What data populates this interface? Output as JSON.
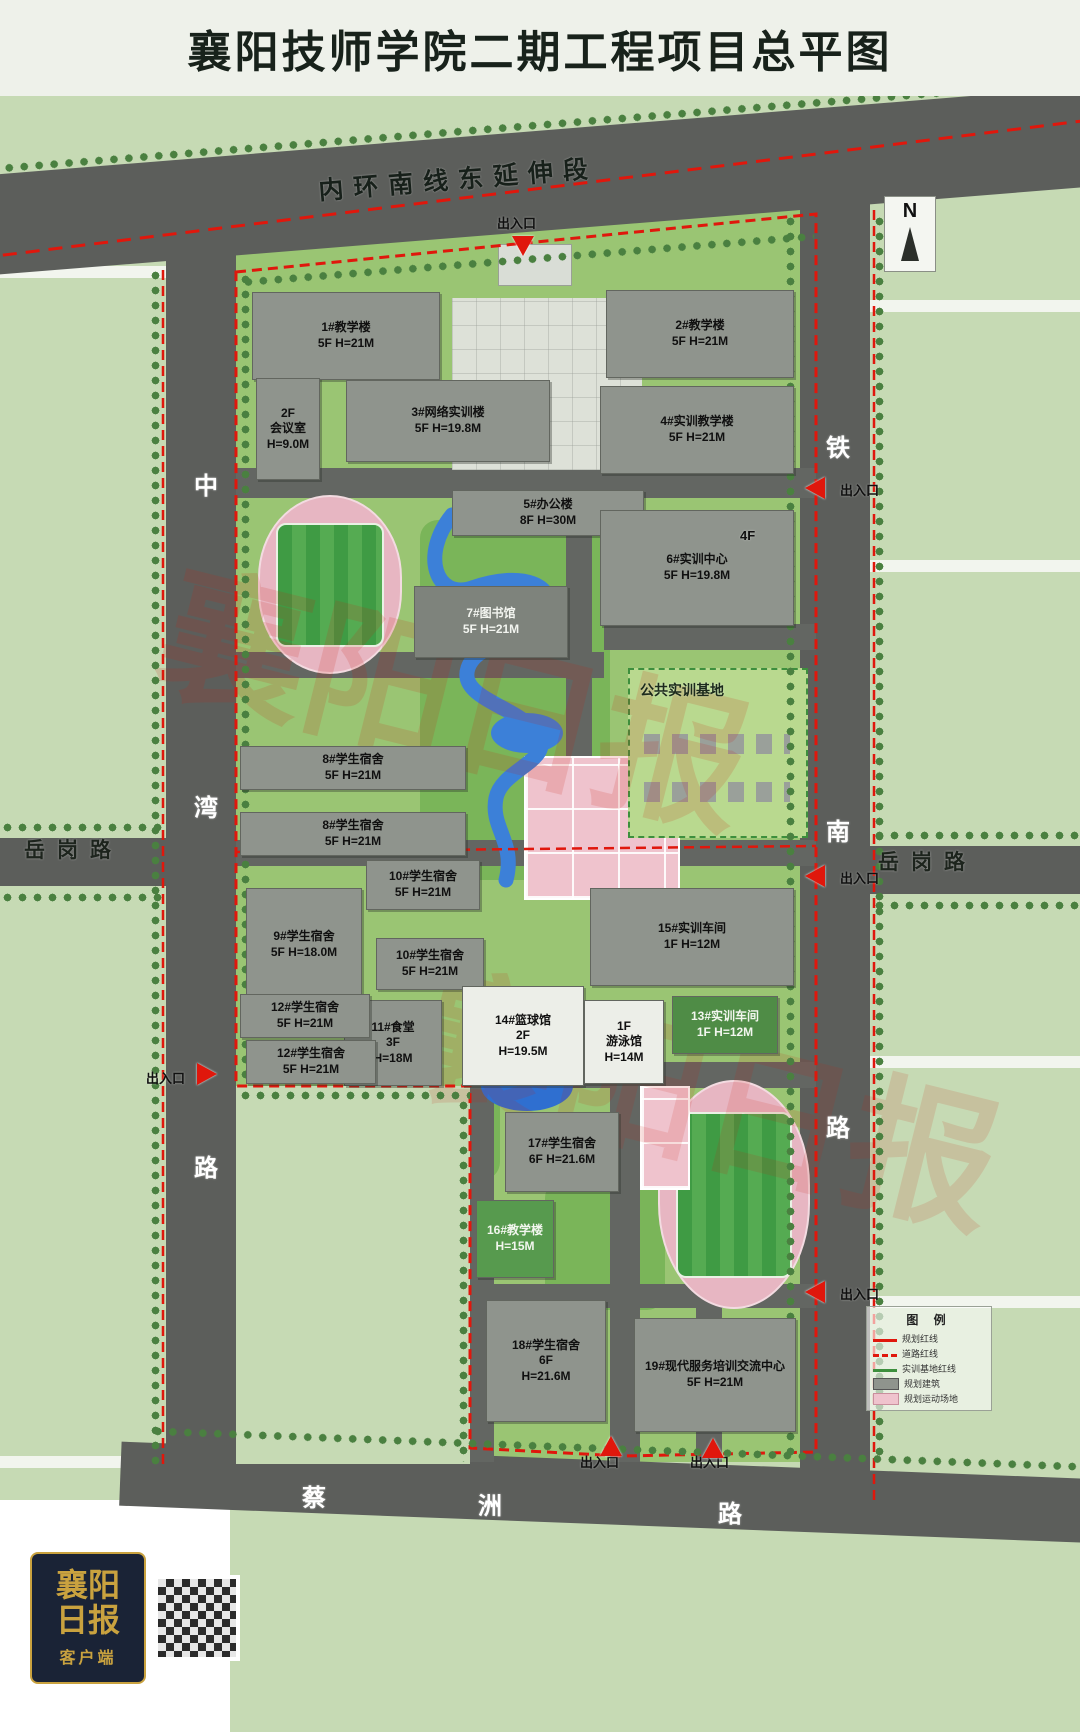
{
  "title": "襄阳技师学院二期工程项目总平图",
  "compass": {
    "label": "N"
  },
  "footer": {
    "logo_title": "襄阳日报",
    "logo_sub": "客户端"
  },
  "watermark": {
    "text": "襄阳日报",
    "color": "#cc2211"
  },
  "colors": {
    "road": "#5c5e5b",
    "campus_green": "#9ac573",
    "outer_green": "#c6dab4",
    "building_gray": "#8f948d",
    "red_line": "#e0170c",
    "track_pink": "#e7b6c2",
    "field_green": "#3f9b44",
    "water_blue": "#3c80d8",
    "header_bg": "#eef1ea"
  },
  "legend": {
    "title": "图 例",
    "items": [
      {
        "swatch": "red-line",
        "label": "规划红线"
      },
      {
        "swatch": "red-dash",
        "label": "道路红线"
      },
      {
        "swatch": "green-line",
        "label": "实训基地红线"
      },
      {
        "swatch": "gray-box",
        "label": "规划建筑"
      },
      {
        "swatch": "pink-box",
        "label": "规划运动场地"
      }
    ]
  },
  "roads": {
    "north": "内环南线东延伸段",
    "west_vertical": "中湾路",
    "east_vertical": "铁南路",
    "west_horizontal": "岳岗路",
    "east_horizontal": "岳岗路",
    "south": "蔡洲路",
    "entrance_label": "出入口"
  },
  "map": {
    "buildings": [
      {
        "id": "1",
        "lines": [
          "1#教学楼",
          "5F H=21M"
        ],
        "x": 252,
        "y": 292,
        "w": 186,
        "h": 86
      },
      {
        "id": "2",
        "lines": [
          "2#教学楼",
          "5F H=21M"
        ],
        "x": 606,
        "y": 290,
        "w": 186,
        "h": 86
      },
      {
        "id": "conf",
        "lines": [
          "2F",
          "会议室",
          "H=9.0M"
        ],
        "x": 256,
        "y": 378,
        "w": 62,
        "h": 100
      },
      {
        "id": "3",
        "lines": [
          "3#网络实训楼",
          "5F H=19.8M"
        ],
        "x": 346,
        "y": 380,
        "w": 202,
        "h": 80
      },
      {
        "id": "4",
        "lines": [
          "4#实训教学楼",
          "5F H=21M"
        ],
        "x": 600,
        "y": 386,
        "w": 192,
        "h": 86
      },
      {
        "id": "5",
        "lines": [
          "5#办公楼",
          "8F H=30M"
        ],
        "x": 452,
        "y": 490,
        "w": 190,
        "h": 44
      },
      {
        "id": "6",
        "lines": [
          "6#实训中心",
          "5F H=19.8M"
        ],
        "x": 600,
        "y": 510,
        "w": 192,
        "h": 114
      },
      {
        "id": "7",
        "lines": [
          "7#图书馆",
          "5F H=21M"
        ],
        "x": 414,
        "y": 586,
        "w": 152,
        "h": 70,
        "fill": "#7e837c",
        "text": "#f2f4ef"
      },
      {
        "id": "8a",
        "lines": [
          "8#学生宿舍",
          "5F H=21M"
        ],
        "x": 240,
        "y": 746,
        "w": 224,
        "h": 42
      },
      {
        "id": "8b",
        "lines": [
          "8#学生宿舍",
          "5F H=21M"
        ],
        "x": 240,
        "y": 812,
        "w": 224,
        "h": 42
      },
      {
        "id": "10a",
        "lines": [
          "10#学生宿舍",
          "5F H=21M"
        ],
        "x": 366,
        "y": 860,
        "w": 112,
        "h": 48
      },
      {
        "id": "9",
        "lines": [
          "9#学生宿舍",
          "5F H=18.0M"
        ],
        "x": 246,
        "y": 888,
        "w": 114,
        "h": 112
      },
      {
        "id": "10b",
        "lines": [
          "10#学生宿舍",
          "5F H=21M"
        ],
        "x": 376,
        "y": 938,
        "w": 106,
        "h": 50
      },
      {
        "id": "11",
        "lines": [
          "11#食堂",
          "3F",
          "H=18M"
        ],
        "x": 344,
        "y": 1000,
        "w": 96,
        "h": 84
      },
      {
        "id": "15",
        "lines": [
          "15#实训车间",
          "1F H=12M"
        ],
        "x": 590,
        "y": 888,
        "w": 202,
        "h": 96
      },
      {
        "id": "14",
        "lines": [
          "14#篮球馆",
          "2F",
          "H=19.5M"
        ],
        "x": 462,
        "y": 986,
        "w": 120,
        "h": 98,
        "fill": "#eceee8"
      },
      {
        "id": "swim",
        "lines": [
          "1F",
          "游泳馆",
          "H=14M"
        ],
        "x": 584,
        "y": 1000,
        "w": 78,
        "h": 82,
        "fill": "#eceee8"
      },
      {
        "id": "13",
        "lines": [
          "13#实训车间",
          "1F H=12M"
        ],
        "x": 672,
        "y": 996,
        "w": 104,
        "h": 56,
        "fill": "#4f8c46",
        "text": "#f2f6ee"
      },
      {
        "id": "12a",
        "lines": [
          "12#学生宿舍",
          "5F H=21M"
        ],
        "x": 240,
        "y": 994,
        "w": 128,
        "h": 42
      },
      {
        "id": "12b",
        "lines": [
          "12#学生宿舍",
          "5F H=21M"
        ],
        "x": 246,
        "y": 1040,
        "w": 128,
        "h": 42
      },
      {
        "id": "17",
        "lines": [
          "17#学生宿舍",
          "6F H=21.6M"
        ],
        "x": 505,
        "y": 1112,
        "w": 112,
        "h": 78
      },
      {
        "id": "16",
        "lines": [
          "16#教学楼",
          "H=15M"
        ],
        "x": 476,
        "y": 1200,
        "w": 76,
        "h": 76,
        "fill": "#579a4e",
        "text": "#f2f6ee"
      },
      {
        "id": "18",
        "lines": [
          "18#学生宿舍",
          "6F",
          "H=21.6M"
        ],
        "x": 486,
        "y": 1300,
        "w": 118,
        "h": 120
      },
      {
        "id": "19",
        "lines": [
          "19#现代服务培训交流中心",
          "5F H=21M"
        ],
        "x": 634,
        "y": 1318,
        "w": 160,
        "h": 112
      }
    ],
    "labels": [
      {
        "name": "road-name-north",
        "text": "内环南线东延伸段",
        "x": 318,
        "y": 160,
        "size": 25,
        "ls": 10,
        "rot": -4.6,
        "color": "#17201a"
      },
      {
        "name": "entrance-label-top",
        "text": "出入口",
        "x": 497,
        "y": 213,
        "size": 13
      },
      {
        "name": "entrance-label-east-1",
        "text": "出入口",
        "x": 840,
        "y": 480,
        "size": 13
      },
      {
        "name": "entrance-label-east-2",
        "text": "出入口",
        "x": 840,
        "y": 868,
        "size": 13
      },
      {
        "name": "entrance-label-west",
        "text": "出入口",
        "x": 146,
        "y": 1068,
        "size": 13
      },
      {
        "name": "entrance-label-east-3",
        "text": "出入口",
        "x": 840,
        "y": 1284,
        "size": 13
      },
      {
        "name": "entrance-label-south-1",
        "text": "出入口",
        "x": 580,
        "y": 1452,
        "size": 13
      },
      {
        "name": "entrance-label-south-2",
        "text": "出入口",
        "x": 690,
        "y": 1452,
        "size": 13
      },
      {
        "name": "road-name-west-char-1",
        "text": "中",
        "x": 194,
        "y": 466,
        "size": 24,
        "color": "#ffffff"
      },
      {
        "name": "road-name-west-char-2",
        "text": "湾",
        "x": 194,
        "y": 788,
        "size": 24,
        "color": "#ffffff"
      },
      {
        "name": "road-name-west-char-3",
        "text": "路",
        "x": 194,
        "y": 1148,
        "size": 24,
        "color": "#ffffff"
      },
      {
        "name": "road-name-east-char-1",
        "text": "铁",
        "x": 826,
        "y": 428,
        "size": 24,
        "color": "#ffffff"
      },
      {
        "name": "road-name-east-char-2",
        "text": "南",
        "x": 826,
        "y": 812,
        "size": 24,
        "color": "#ffffff"
      },
      {
        "name": "road-name-east-char-3",
        "text": "路",
        "x": 826,
        "y": 1108,
        "size": 24,
        "color": "#ffffff"
      },
      {
        "name": "road-name-yuegang-left",
        "text": "岳岗路",
        "x": 24,
        "y": 834,
        "size": 21,
        "ls": 12,
        "color": "#1d241d"
      },
      {
        "name": "road-name-yuegang-right",
        "text": "岳岗路",
        "x": 878,
        "y": 846,
        "size": 21,
        "ls": 12,
        "color": "#1d241d"
      },
      {
        "name": "road-name-south-char-1",
        "text": "蔡",
        "x": 302,
        "y": 1478,
        "size": 24,
        "color": "#ffffff"
      },
      {
        "name": "road-name-south-char-2",
        "text": "洲",
        "x": 478,
        "y": 1486,
        "size": 24,
        "color": "#ffffff"
      },
      {
        "name": "road-name-south-char-3",
        "text": "路",
        "x": 718,
        "y": 1494,
        "size": 24,
        "color": "#ffffff"
      },
      {
        "name": "area-label-training-base",
        "text": "公共实训基地",
        "x": 640,
        "y": 680,
        "size": 14,
        "color": "#1c2a1c"
      },
      {
        "name": "floor-label-4f",
        "text": "4F",
        "x": 740,
        "y": 528,
        "size": 13
      }
    ],
    "entrances": [
      {
        "x": 512,
        "y": 236,
        "rot": 180
      },
      {
        "x": 804,
        "y": 478,
        "rot": -90
      },
      {
        "x": 804,
        "y": 866,
        "rot": -90
      },
      {
        "x": 196,
        "y": 1064,
        "rot": 90
      },
      {
        "x": 804,
        "y": 1282,
        "rot": -90
      },
      {
        "x": 600,
        "y": 1436,
        "rot": 0
      },
      {
        "x": 702,
        "y": 1438,
        "rot": 0
      }
    ]
  }
}
